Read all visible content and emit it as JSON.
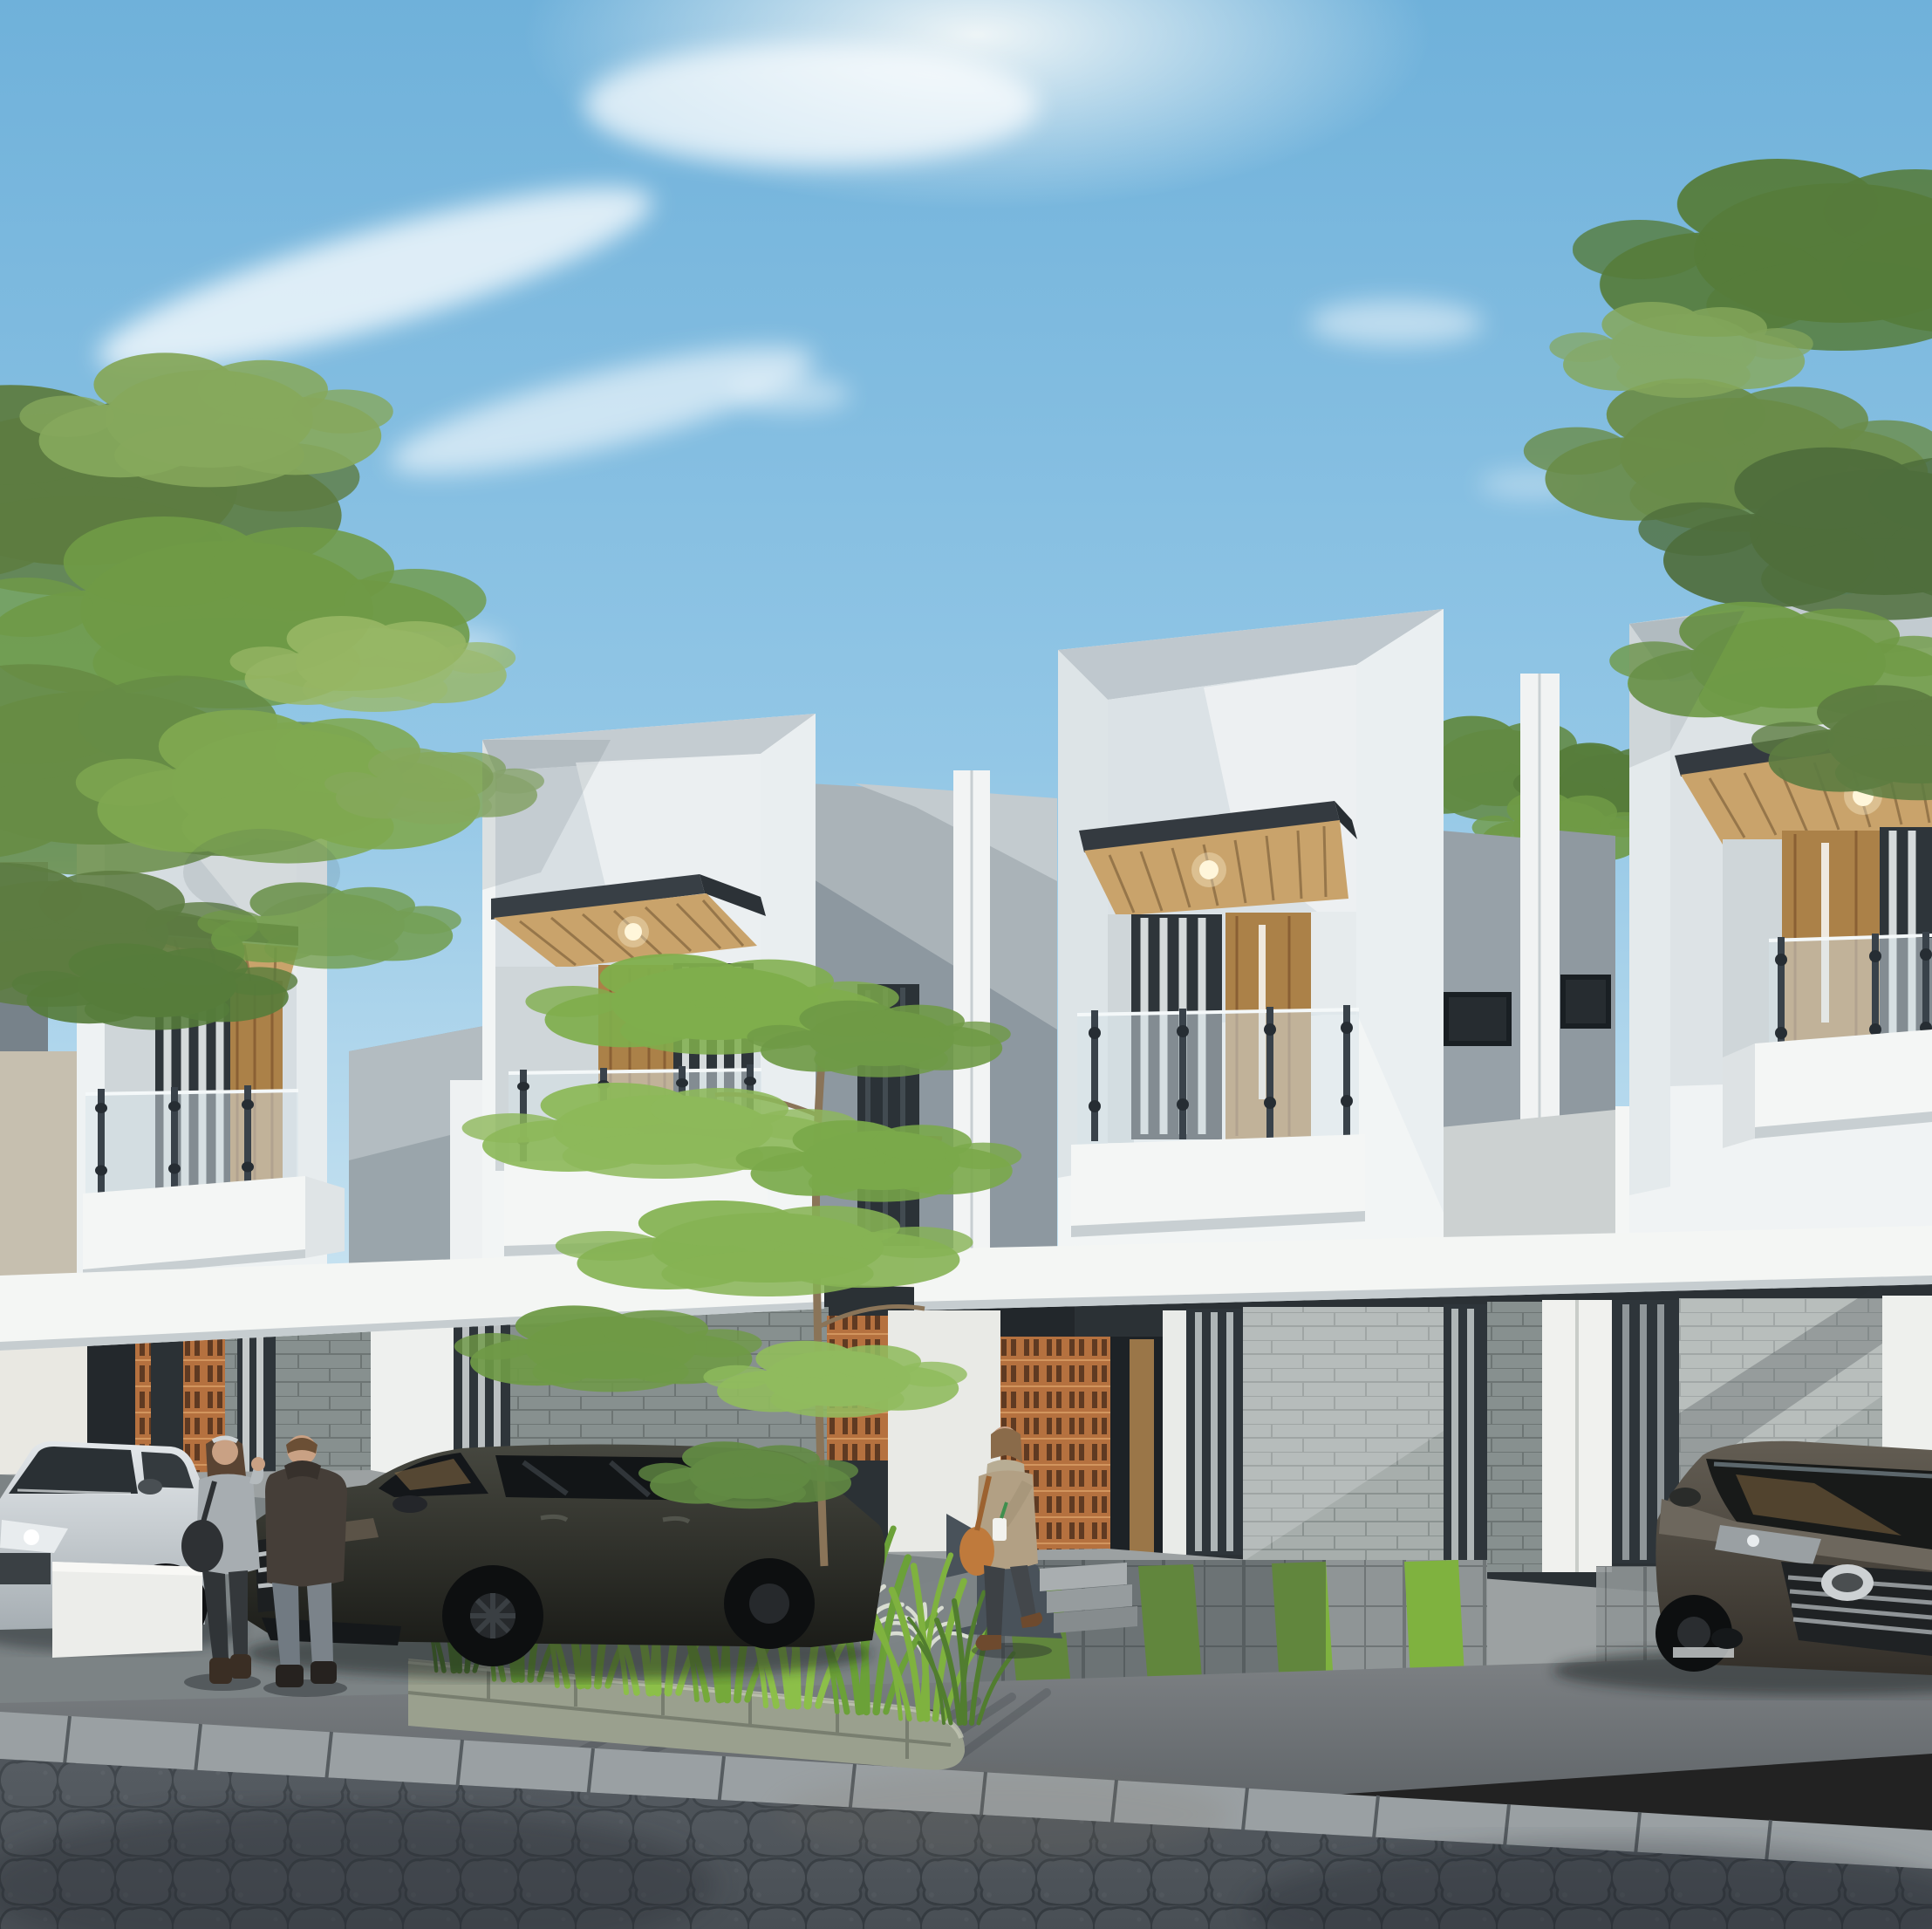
{
  "scene": {
    "title": "Modern minimalist townhouse row - daytime exterior architectural render",
    "time_of_day": "day, strong sun from upper right, long diagonal shadows on facades",
    "houses": [
      {
        "id": 1,
        "position": "far left, closest to camera",
        "features": [
          "white recessed box frame upper floor",
          "wood slat canopy soffit with recessed downlight",
          "corner glass balustrade balcony with steel posts",
          "wood door and curtained window",
          "white balcony box",
          "carport with white fascia, stone block wall, terracotta roster strip"
        ]
      },
      {
        "id": 2,
        "position": "second from left",
        "features": [
          "white recessed box frame upper floor",
          "wood slat canopy with downlight",
          "glass balustrade balcony",
          "wood door with glass sidelight",
          "white balcony box",
          "stone clad ground floor behind foreground tree"
        ]
      },
      {
        "id": 3,
        "position": "center right, most prominent",
        "features": [
          "white recessed box frame upper floor",
          "steel fascia + wood slat canopy with downlight",
          "glass balustrade",
          "wood door with white pull stripe and curtained window",
          "white balcony box",
          "sunlit stone block ground wall",
          "entry porch with terracotta roster screens, clerestory window, ceiling downlight",
          "concrete steps",
          "driveway with grass strips"
        ]
      },
      {
        "id": 4,
        "position": "far right, partly behind tree",
        "features": [
          "white recessed box frame upper floor",
          "wood slat canopy with downlight",
          "glass balustrade",
          "wood sliding door",
          "white balcony box",
          "sunlit stone wall",
          "driveway with parked MPV"
        ]
      }
    ],
    "party_walls": "between houses: gray stucco parapet walls with narrow dark windows, paired white fin pilasters, small horizontal clerestory windows",
    "vehicles": [
      {
        "id": "silver-suv",
        "description": "silver/white SUV parked far left behind low white wall, front cut by image edge"
      },
      {
        "id": "dark-suv",
        "description": "dark olive-gray MPV/SUV parked facing left, chrome grille, black alloy wheels"
      },
      {
        "id": "toyota-mpv",
        "description": "bronze-gray Toyota MPV at right, black slatted grille with chrome trim and Toyota emblem, windshield reflecting carport wood ceiling"
      }
    ],
    "people": [
      {
        "id": "woman-left",
        "description": "woman with long brown hair, light gray hoodie, dark pants, dark shoulder bag, gesturing"
      },
      {
        "id": "man-left",
        "description": "man seen from behind, dark brown hooded jacket, gray-blue jeans, dark shoes"
      },
      {
        "id": "woman-walking",
        "description": "woman in khaki jacket with scarf, orange shoulder bag, holding white coffee cup with green straw, dark jeans, brown shoes, walking near entry steps"
      }
    ],
    "landscape": {
      "left_tree": "large leafy tree overhanging houses at upper left",
      "right_tree": "leafy tree canopy at upper right corner",
      "foreground_tree": "slender young tree with layered foliage in front of house 2",
      "gap_shrubs": "green shrub tops between houses 3 and 4",
      "planter": "curved stone-block raised planter with tall green ornamental grasses and pale fountain-grass clumps",
      "grass_strips": "bright green grass strips inset into concrete driveway pavers"
    },
    "street": {
      "foreground": "interlocking scalloped hexagonal paver street, dark gray",
      "curb": "long rectangular curb stones running diagonally",
      "apron": "smooth concrete apron with long grass shadows"
    },
    "sky": "clear blue sky, wispy diagonal cloud streaks, bright sun glow upper area"
  },
  "colors": {
    "sky_top": "#6fb1da",
    "sky_mid": "#93c7e6",
    "sky_horizon": "#d2e8f3",
    "cloud": "#ffffff",
    "sun_glow": "#f4f8f8",
    "foliage_dark": "#50703d",
    "foliage_mid": "#6f9a46",
    "foliage_light": "#9cba68",
    "facade_white": "#f2f5f5",
    "facade_light": "#e8eef0",
    "facade_shade": "#d7dee2",
    "facade_deep": "#bdc7cd",
    "stucco": "#aab3b8",
    "stucco_shade": "#939ea5",
    "steel": "#343a40",
    "wood_light": "#c9a36b",
    "wood_mid": "#ab8148",
    "wood_dark": "#8a6034",
    "frame_dark": "#2e353a",
    "glass_dark": "#23282c",
    "curtain": "#e8eced",
    "stone_lit": "#a7aeac",
    "stone_shade": "#87908f",
    "roster": "#b5713f",
    "roster_slot": "#5f3a22",
    "concrete": "#9ca1a2",
    "apron": "#75797c",
    "curb": "#9aa0a3",
    "street": "#4b5157",
    "grass": "#7fb23f",
    "grass_dark": "#517d2f",
    "fountain": "#d9ddd2",
    "planter_stone": "#9aa08e",
    "soil": "#2f2b26",
    "suv_silver": "#ccd3d7",
    "suv_dark": "#35362f",
    "toyota": "#4e4942",
    "chrome": "#c3c8ca",
    "tire": "#101214",
    "skin": "#c9a184",
    "hair_brown": "#5a4433",
    "hoodie": "#a7adb1",
    "jacket_dark": "#453e38",
    "jeans_light": "#717a82",
    "jeans_dark": "#3d4145",
    "khaki": "#b2a084",
    "bag_orange": "#bf7a3c"
  }
}
